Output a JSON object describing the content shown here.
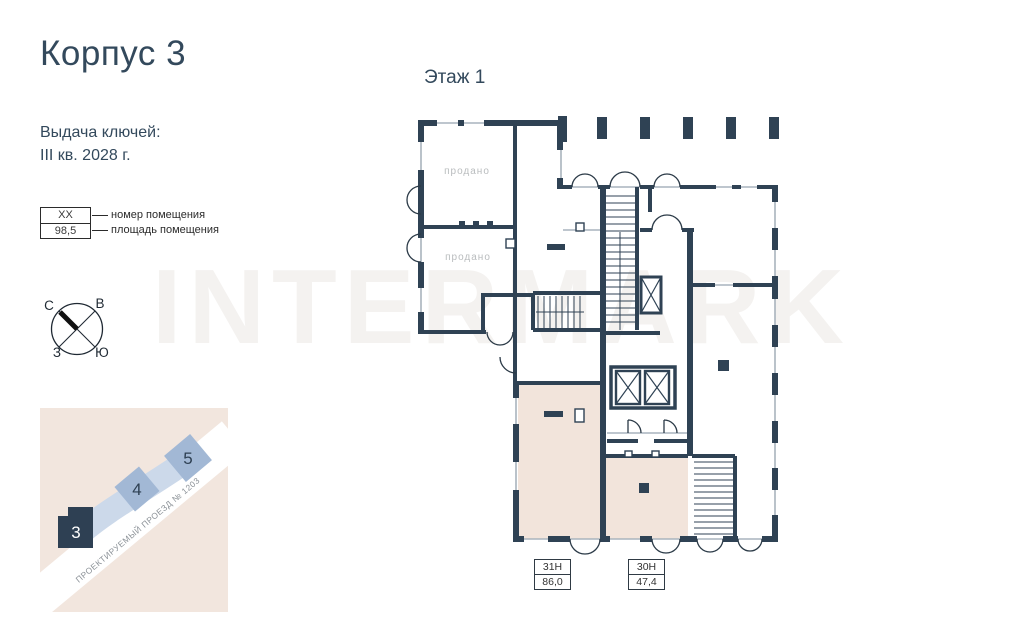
{
  "page": {
    "title": "Корпус 3",
    "floor_label": "Этаж 1",
    "watermark": "INTERMARK"
  },
  "handover": {
    "line1": "Выдача ключей:",
    "line2": "III кв. 2028 г."
  },
  "legend": {
    "number_placeholder": "XX",
    "area_placeholder": "98,5",
    "number_label": "номер помещения",
    "area_label": "площадь помещения"
  },
  "compass": {
    "north": "С",
    "east": "В",
    "west": "З",
    "south": "Ю"
  },
  "site_map": {
    "road_name": "ПРОЕКТИРУЕМЫЙ ПРОЕЗД № 1203",
    "buildings": [
      {
        "label": "3",
        "highlighted": true
      },
      {
        "label": "4",
        "highlighted": false
      },
      {
        "label": "5",
        "highlighted": false
      }
    ]
  },
  "floor_plan": {
    "sold_rooms": [
      "продано",
      "продано"
    ],
    "units": [
      {
        "number": "31Н",
        "area": "86,0"
      },
      {
        "number": "30Н",
        "area": "47,4"
      }
    ]
  },
  "colors": {
    "wall_dark": "#2F4254",
    "window_gray": "#A9B4BD",
    "unit_fill": "#F2E4DB",
    "site_beige": "#F2E6DE",
    "site_blue_band": "#CCD9EA",
    "building_blue": "#A2B8D5",
    "text_dark": "#33495C",
    "sold_text": "#B9BCBE"
  }
}
